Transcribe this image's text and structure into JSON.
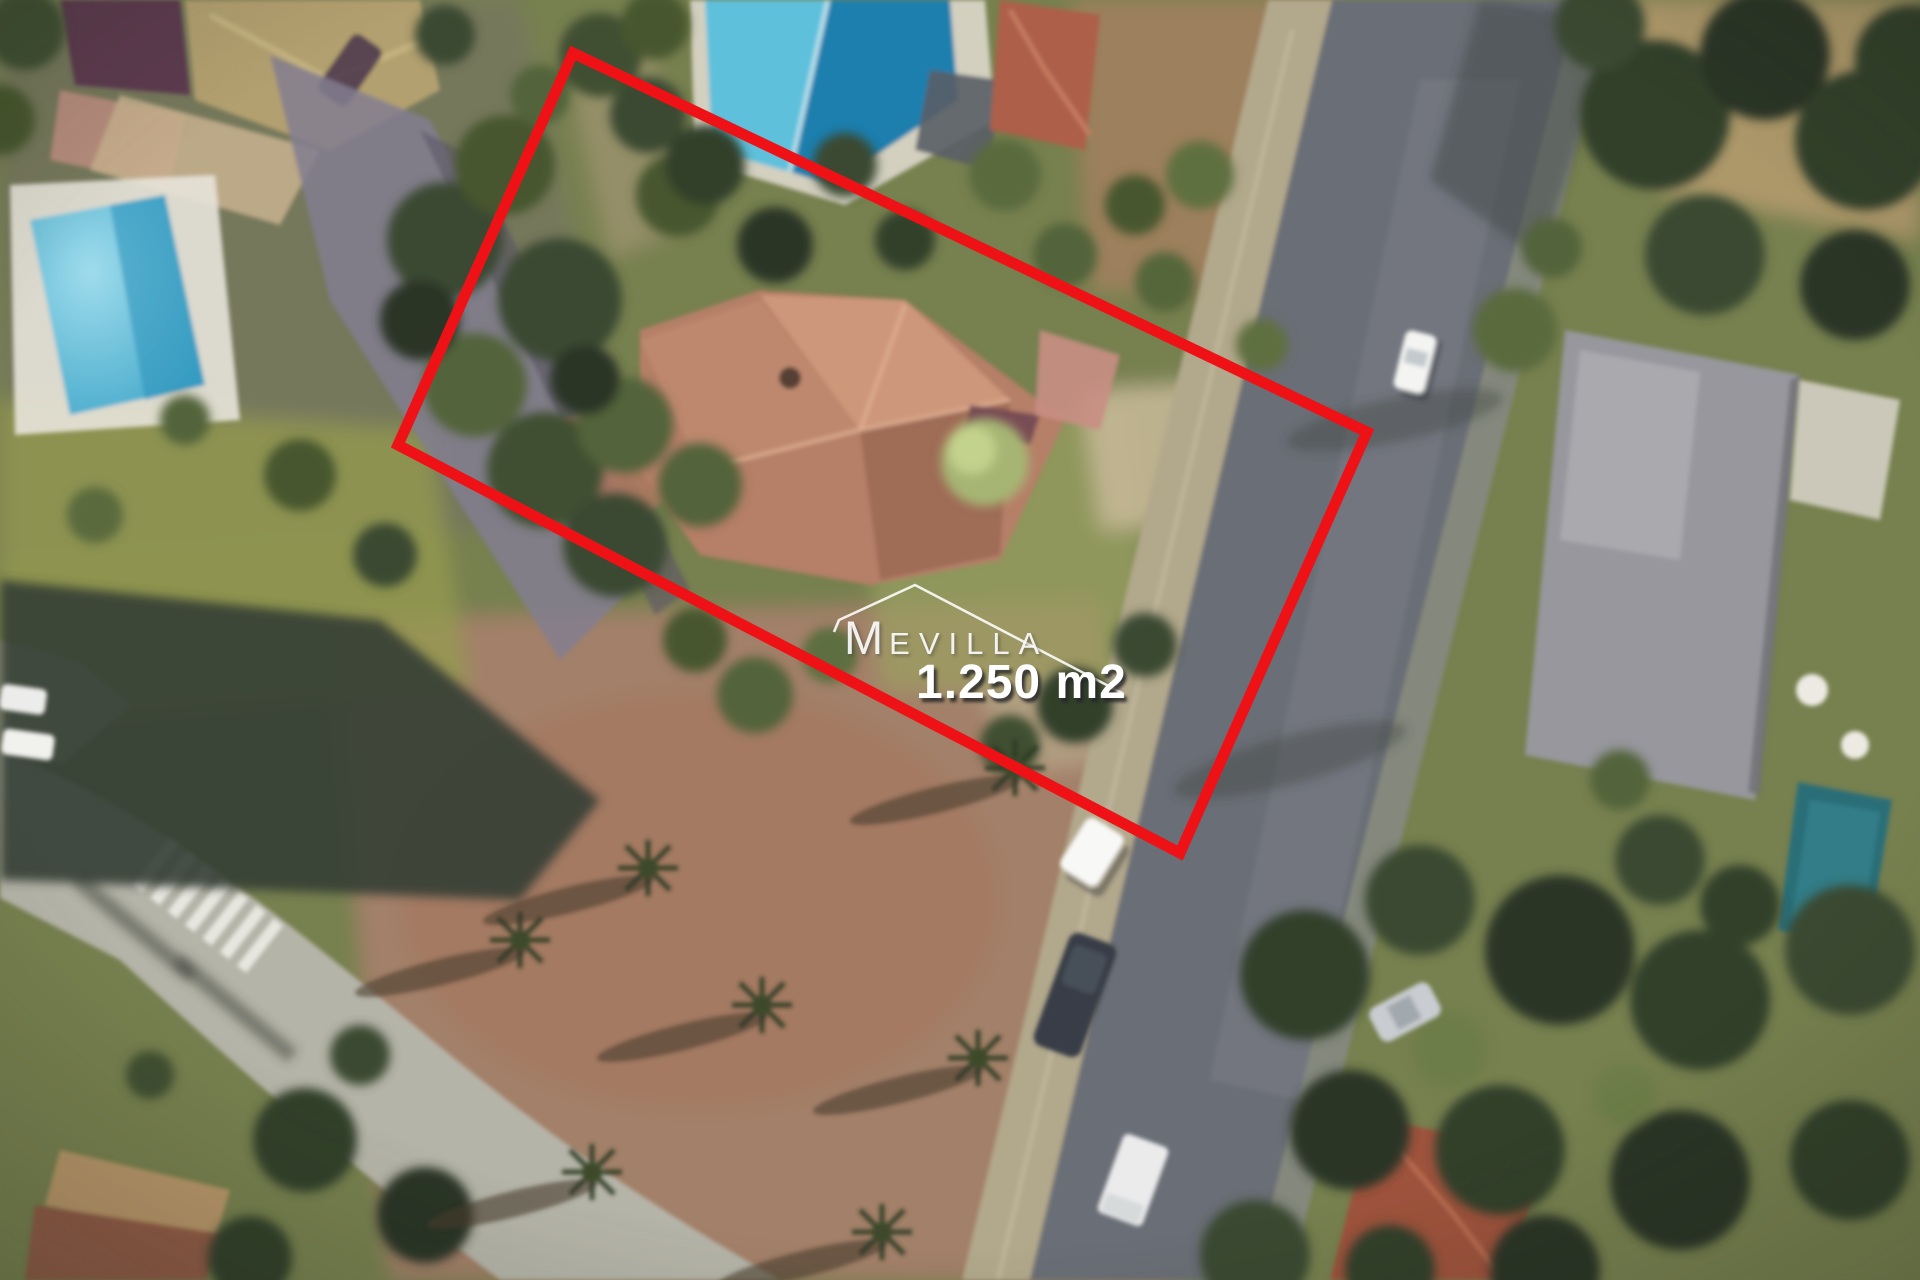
{
  "image": {
    "kind": "aerial-satellite-photo",
    "width_px": 1920,
    "height_px": 1280
  },
  "watermark": {
    "brand_initial": "M",
    "brand_rest": "EVILLA",
    "roof_icon": "roof-outline-icon",
    "color": "#fcfcfc"
  },
  "area_label": {
    "value": "1.250 m2",
    "color": "#ffffff"
  },
  "plot_outline": {
    "color": "#ee1216",
    "stroke_width": 11,
    "points": "573,53 1367,432 1180,853 398,445"
  },
  "palette": {
    "pool_light_blue": "#5fc0dc",
    "pool_deep_blue": "#1d7fae",
    "pool_teal": "#2c6e78",
    "roof_terracotta": "#b67f68",
    "roof_maroon": "#5d3a50",
    "roof_red_tile": "#ad5f49",
    "asphalt_gray": "#6b6e76",
    "road_light_gray": "#b5b4a8",
    "sidewalk_tan": "#b2a88c",
    "dirt_tan": "#a5806a",
    "vegetation_dark": "#33402a",
    "vegetation_mid": "#52643a",
    "grass_olive": "#93994f"
  }
}
